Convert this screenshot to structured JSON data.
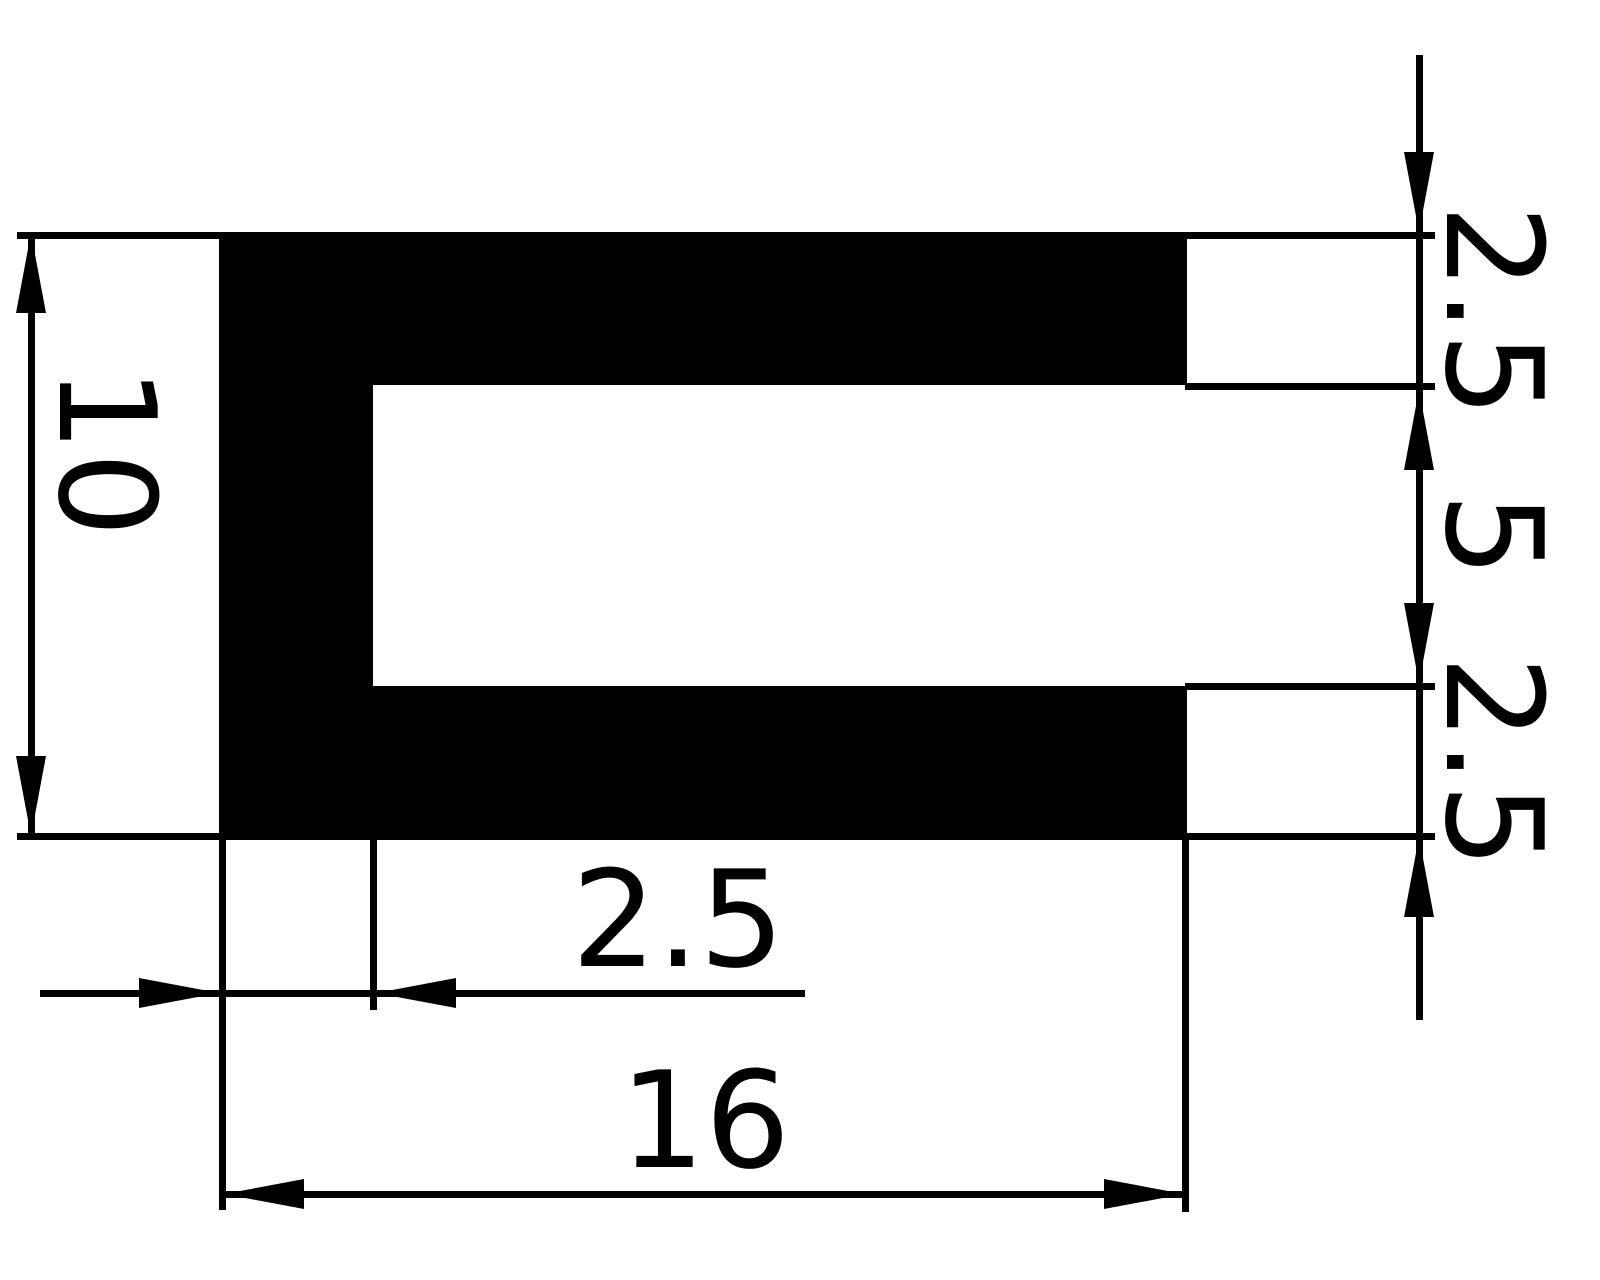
{
  "drawing": {
    "title": "U-channel profile cross-section",
    "colors": {
      "ink": "#000000",
      "background": "#ffffff"
    },
    "labels": {
      "height_total": "10",
      "top_wall": "2.5",
      "slot_height": "5",
      "bottom_wall": "2.5",
      "left_wall": "2.5",
      "width_total": "16"
    }
  }
}
